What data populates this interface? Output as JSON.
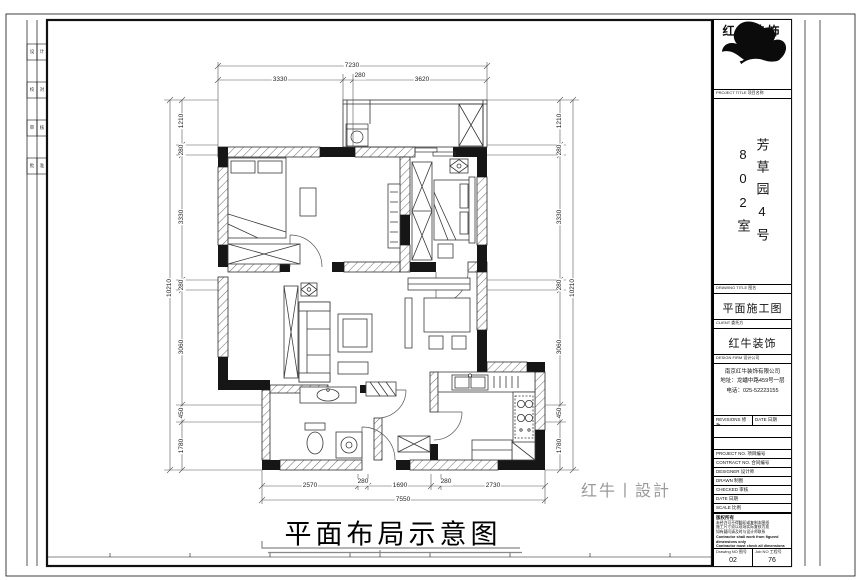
{
  "title_block": {
    "brand": "红牛装饰",
    "project_label": "PROJECT TITLE 项目名称",
    "project_name": "芳草园4号802室",
    "drawing_title_label": "DRAWING TITLE 图名",
    "drawing_title": "平面施工图",
    "client_label": "CLIENT 委托方",
    "client": "红牛装饰",
    "firm_label": "DESIGN FIRM 设计公司",
    "firm_name": "南京红牛装饰有限公司",
    "firm_address": "地址：龙蟠中路459号一层",
    "firm_phone": "电话：025-52223155",
    "revisions_label": "REVISIONS 修改",
    "date_label": "DATE 日期",
    "info_rows": [
      {
        "label": "PROJECT NO. 项目编号"
      },
      {
        "label": "CONTRACT NO. 合同编号"
      },
      {
        "label": "DESIGNER 设计师"
      },
      {
        "label": "DRAWN 制图"
      },
      {
        "label": "CHECKED 审核"
      },
      {
        "label": "DATE 日期"
      },
      {
        "label": "SCALE 比例"
      }
    ],
    "notes_title": "版权所有",
    "notes_lines": [
      "未经许可不得翻印或复制本图纸",
      "施工尺寸须以现场实际复核为准",
      "如有疑问请及时与设计师联系",
      "Contractor shall work from figured dimensions only",
      "Contractor must check all dimensions on site",
      "Contractor must be agreed amendments in drawing"
    ],
    "drawing_no_label": "Drawing NO 图号",
    "drawing_no": "02",
    "job_no_label": "Job NO 工程号",
    "job_no": "76"
  },
  "plan": {
    "caption": "平面布局示意图",
    "watermark": "红牛丨設計",
    "dims": {
      "top_total": "7230",
      "top": [
        "3330",
        "280",
        "3620"
      ],
      "bottom": [
        "2570",
        "280",
        "1690",
        "280",
        "2730"
      ],
      "bottom_total": "7550",
      "left": [
        "1210",
        "280",
        "3330",
        "280",
        "3060",
        "450",
        "1780"
      ],
      "left_total": "10210",
      "right": [
        "1210",
        "280",
        "3330",
        "280",
        "3060",
        "450",
        "1780"
      ],
      "right_total": "10210"
    }
  },
  "binding_cells": [
    [
      "设",
      "计"
    ],
    [
      "校",
      "对"
    ],
    [
      "审",
      "核"
    ],
    [
      "批",
      "准"
    ]
  ],
  "colors": {
    "line": "#222222",
    "hatch": "#777777",
    "watermark": "#9a9a9a"
  }
}
